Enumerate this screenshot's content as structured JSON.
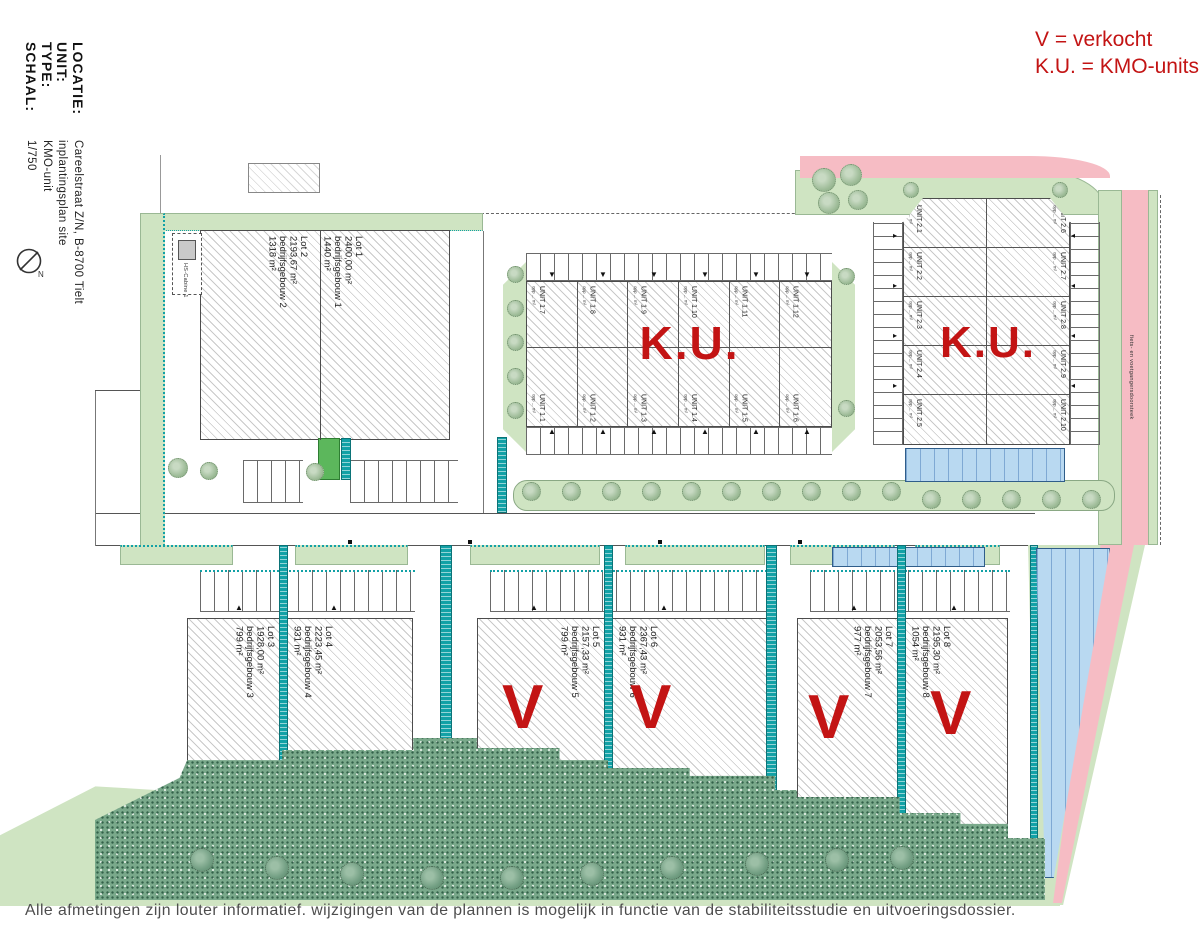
{
  "legend": {
    "sold": "V = verkocht",
    "units": "K.U. = KMO-units"
  },
  "title_block": {
    "rows": [
      {
        "label": "LOCATIE:",
        "value": "Careelstraat Z/N, B-8700 Tielt"
      },
      {
        "label": "UNIT:",
        "value": "inplantingsplan site"
      },
      {
        "label": "TYPE:",
        "value": "KMO-unit"
      },
      {
        "label": "SCHAAL:",
        "value": "1/750"
      }
    ],
    "north": "N"
  },
  "marks": {
    "sold": "V"
  },
  "ku1": {
    "label": "K.U.",
    "top": [
      "UNIT 1.7",
      "UNIT 1.8",
      "UNIT 1.9",
      "UNIT 1.10",
      "UNIT 1.11",
      "UNIT 1.12"
    ],
    "bottom": [
      "UNIT 1.1",
      "UNIT 1.2",
      "UNIT 1.3",
      "UNIT 1.4",
      "UNIT 1.5",
      "UNIT 1.6"
    ],
    "area_note": "opp ... m²"
  },
  "ku2": {
    "label": "K.U.",
    "left": [
      "UNIT 2.1",
      "UNIT 2.2",
      "UNIT 2.3",
      "UNIT 2.4",
      "UNIT 2.5"
    ],
    "right": [
      "UNIT 2.6",
      "UNIT 2.7",
      "UNIT 2.8",
      "UNIT 2.9",
      "UNIT 2.10"
    ],
    "area_note": "opp ... m²"
  },
  "lots": [
    {
      "name": "Lot 1",
      "area": "2400,00 m²",
      "building": "bedrijfsgebouw 1",
      "footprint": "1440 m²",
      "sold": false
    },
    {
      "name": "Lot 2",
      "area": "2193,67 m²",
      "building": "bedrijfsgebouw 2",
      "footprint": "1318 m²",
      "sold": false
    },
    {
      "name": "Lot 3",
      "area": "1928,00 m²",
      "building": "bedrijfsgebouw 3",
      "footprint": "799 m²",
      "sold": false
    },
    {
      "name": "Lot 4",
      "area": "2223,45 m²",
      "building": "bedrijfsgebouw 4",
      "footprint": "931 m²",
      "sold": false
    },
    {
      "name": "Lot 5",
      "area": "2157,33 m²",
      "building": "bedrijfsgebouw 5",
      "footprint": "799 m²",
      "sold": true
    },
    {
      "name": "Lot 6",
      "area": "2367,43 m²",
      "building": "bedrijfsgebouw 6",
      "footprint": "931 m²",
      "sold": true
    },
    {
      "name": "Lot 7",
      "area": "2053,56 m²",
      "building": "bedrijfsgebouw 7",
      "footprint": "977 m²",
      "sold": true
    },
    {
      "name": "Lot 8",
      "area": "2195,30 m²",
      "building": "bedrijfsgebouw 8",
      "footprint": "1054 m²",
      "sold": true
    }
  ],
  "annotations": {
    "hs_cabine": "HS-Cabine 1",
    "path_label": "fiets- en voetgangersdoorsteek"
  },
  "footer": {
    "disclaimer": "Alle afmetingen zijn louter informatief. wijzigingen van de plannen is mogelijk in functie van de stabiliteitsstudie en uitvoeringsdossier."
  },
  "colors": {
    "accent_red": "#c31414",
    "green": "#cfe4c2",
    "scrub": "#7aa98b",
    "teal": "#12a1a6",
    "water": "#b9d9f1",
    "pink": "#f6bcc4"
  }
}
